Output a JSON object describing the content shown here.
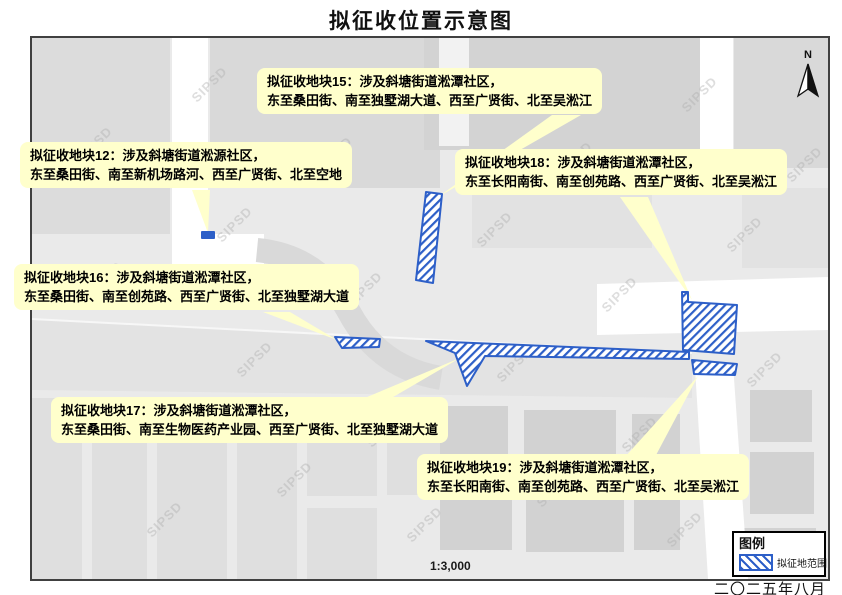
{
  "title": "拟征收位置示意图",
  "date_label": "二〇二五年八月",
  "scale_label": "1:3,000",
  "north_label": "N",
  "watermark": "SIPSD",
  "colors": {
    "parcel_blue": "#2d5fc8",
    "callout_yellow": "#ffffcc",
    "map_background": "#eaeaea",
    "road_white": "#ffffff"
  },
  "legend": {
    "title": "图例",
    "items": [
      {
        "label": "拟征地范围",
        "swatch": "blue-diagonal-hatch"
      }
    ]
  },
  "callouts": [
    {
      "id": "block-15",
      "line1": "拟征收地块15：涉及斜塘街道淞潭社区，",
      "line2": "东至桑田街、南至独墅湖大道、西至广贤街、北至吴淞江"
    },
    {
      "id": "block-12",
      "line1": "拟征收地块12：涉及斜塘街道淞源社区，",
      "line2": "东至桑田街、南至新机场路河、西至广贤街、北至空地"
    },
    {
      "id": "block-18",
      "line1": "拟征收地块18：涉及斜塘街道淞潭社区，",
      "line2": "东至长阳南街、南至创苑路、西至广贤街、北至吴淞江"
    },
    {
      "id": "block-16",
      "line1": "拟征收地块16：涉及斜塘街道淞潭社区，",
      "line2": "东至桑田街、南至创苑路、西至广贤街、北至独墅湖大道"
    },
    {
      "id": "block-17",
      "line1": "拟征收地块17：涉及斜塘街道淞潭社区，",
      "line2": "东至桑田街、南至生物医药产业园、西至广贤街、北至独墅湖大道"
    },
    {
      "id": "block-19",
      "line1": "拟征收地块19：涉及斜塘街道淞潭社区，",
      "line2": "东至长阳南街、南至创苑路、西至广贤街、北至吴淞江"
    }
  ]
}
